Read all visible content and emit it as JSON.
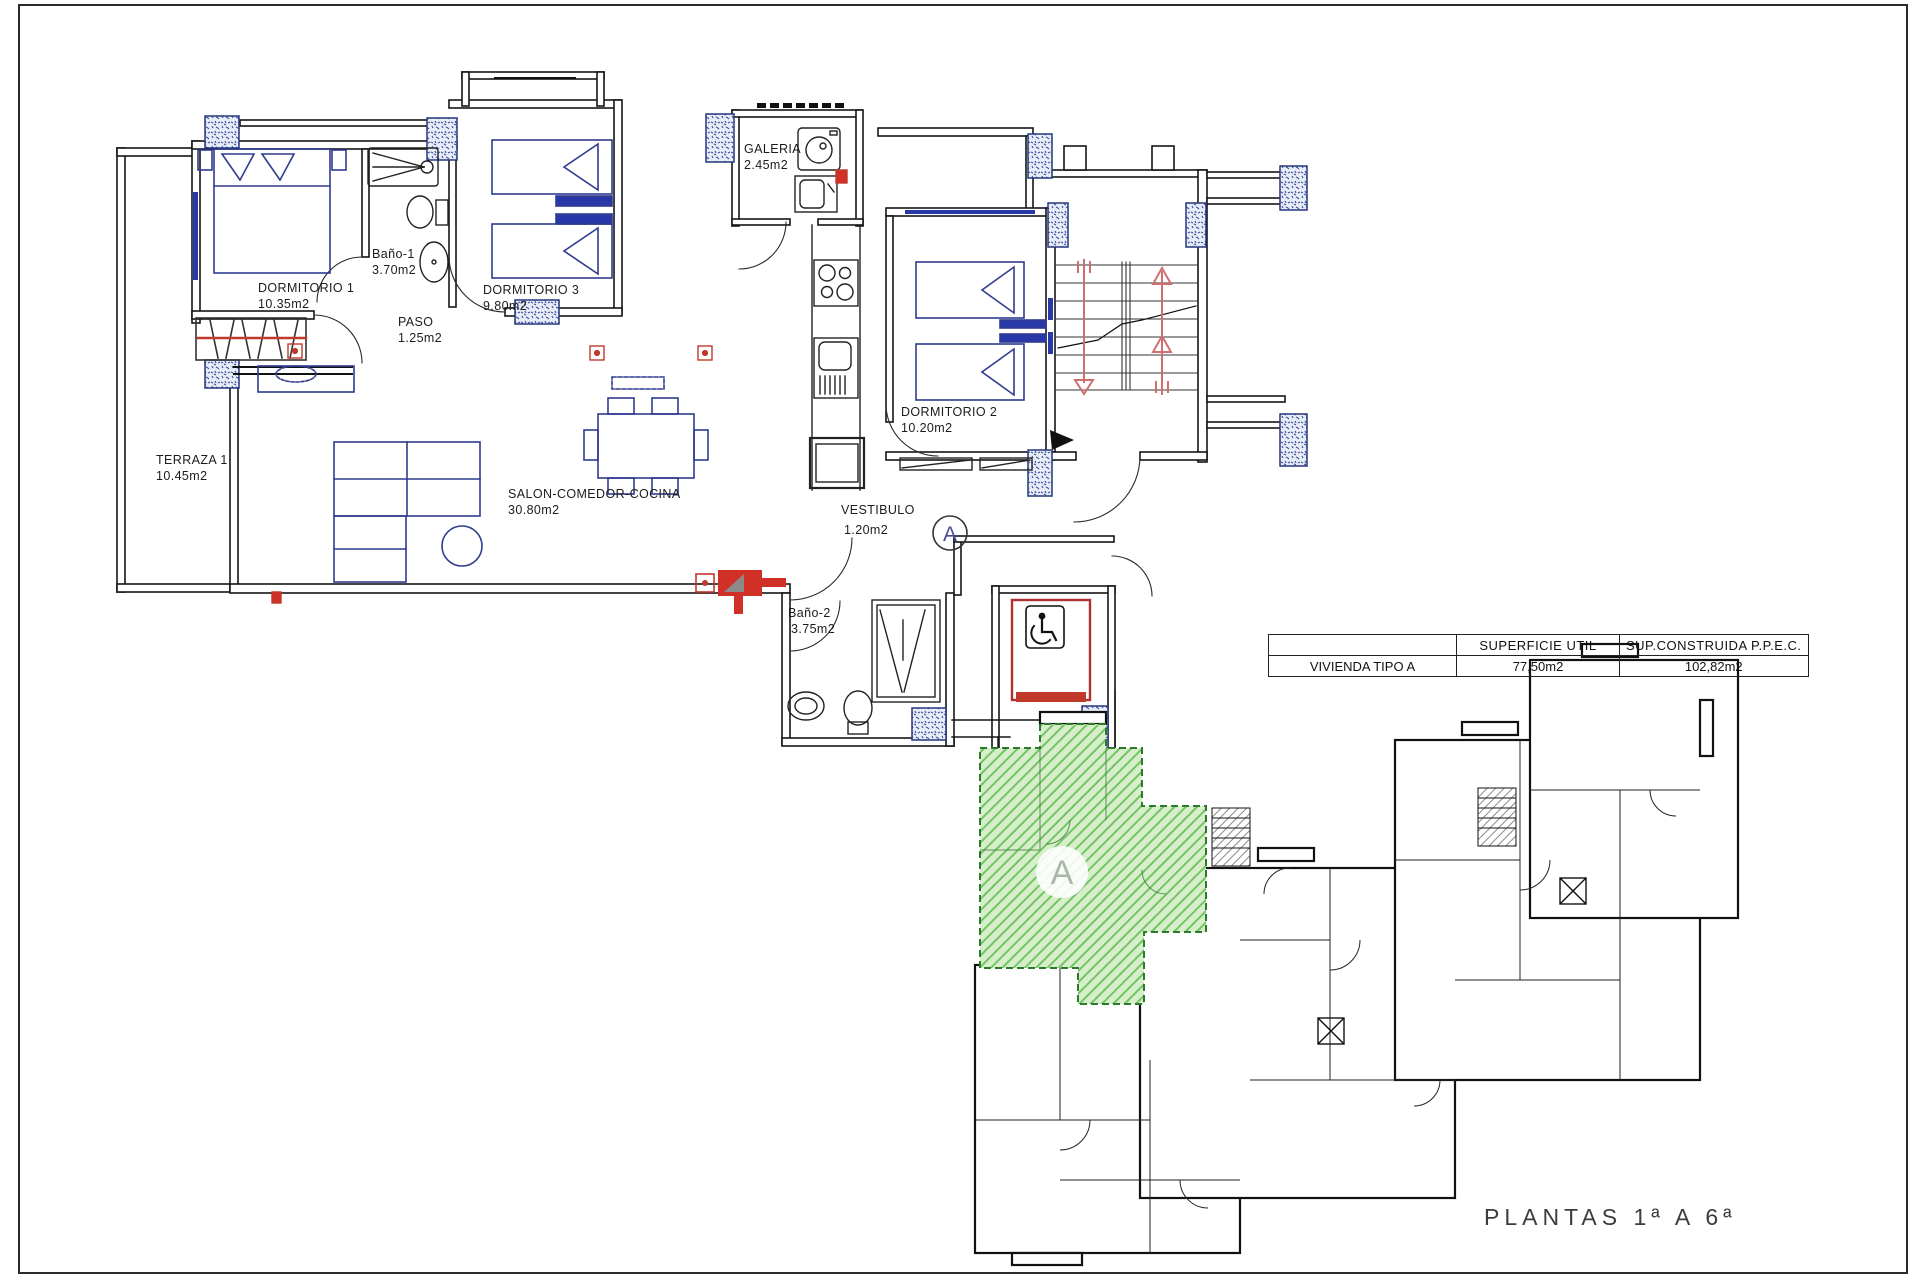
{
  "plan": {
    "rooms": [
      {
        "name": "DORMITORIO 1",
        "area": "10.35m2"
      },
      {
        "name": "Baño-1",
        "area": "3.70m2"
      },
      {
        "name": "PASO",
        "area": "1.25m2"
      },
      {
        "name": "DORMITORIO 3",
        "area": "9.80m2"
      },
      {
        "name": "GALERIA",
        "area": "2.45m2"
      },
      {
        "name": "TERRAZA 1",
        "area": "10.45m2"
      },
      {
        "name": "SALON-COMEDOR-COCINA",
        "area": "30.80m2"
      },
      {
        "name": "DORMITORIO 2",
        "area": "10.20m2"
      },
      {
        "name": "VESTIBULO",
        "area": "1.20m2"
      },
      {
        "name": "Baño-2",
        "area": "3.75m2"
      }
    ],
    "unit_marker": "A"
  },
  "summary_table": {
    "headers": [
      "SUPERFICIE UTIL",
      "SUP.CONSTRUIDA P.P.E.C."
    ],
    "row": {
      "label": "VIVIENDA TIPO A",
      "superficie_util": "77,50m2",
      "sup_construida": "102,82m2"
    }
  },
  "key_plan": {
    "unit_label": "A",
    "caption": "PLANTAS 1ª A 6ª"
  },
  "colors": {
    "highlight_green": "#d6efca",
    "accent_red": "#c03a2b",
    "furniture_navy": "#2f3b8f",
    "wall_hatch_blue": "#3b4fa0"
  }
}
